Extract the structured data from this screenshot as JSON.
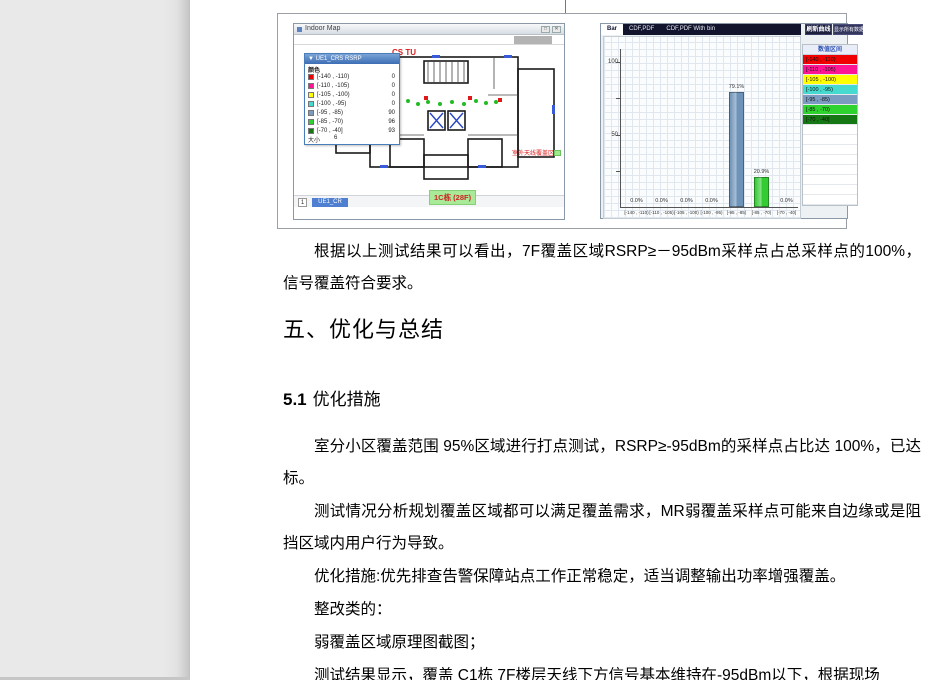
{
  "figure": {
    "indoor_map": {
      "window_title": "Indoor Map",
      "minimize_glyph": "□",
      "close_glyph": "✕",
      "legend": {
        "title": "▼ UE1_CRS RSRP",
        "color_header": "颜色",
        "rows": [
          {
            "range": "[-140 , -110)",
            "count": "0",
            "color": "#f00000"
          },
          {
            "range": "[-110 , -105)",
            "count": "0",
            "color": "#ff1493"
          },
          {
            "range": "[-105 , -100)",
            "count": "0",
            "color": "#ffff00"
          },
          {
            "range": "[-100 , -95)",
            "count": "0",
            "color": "#45d9cf"
          },
          {
            "range": "[-95 , -85)",
            "count": "90",
            "color": "#7b9cc0"
          },
          {
            "range": "[-85 , -70)",
            "count": "96",
            "color": "#2fd32f"
          },
          {
            "range": "[-70 , -40]",
            "count": "93",
            "color": "#157815"
          }
        ],
        "size_label": "大小",
        "size_value": "6"
      },
      "red_fragment": "CS TU",
      "outdoor_note": "室外天线覆盖区",
      "building_label": "1C栋 (28F)",
      "page_box": "1",
      "sheet_tab": "UE1_CR"
    },
    "chart_panel": {
      "tabs": [
        "Bar",
        "CDF,PDF",
        "CDF,PDF With bin"
      ],
      "active_tab": "Bar",
      "refresh_button": "刷新曲线",
      "show_all_button": "显示所有数据",
      "legend_header": "数值区间",
      "legend_rows": [
        {
          "range": "[-140 , -110)",
          "color": "#f00000"
        },
        {
          "range": "[-110 , -105)",
          "color": "#ff1493"
        },
        {
          "range": "[-105 , -100)",
          "color": "#ffff00"
        },
        {
          "range": "[-100 , -95)",
          "color": "#45d9cf"
        },
        {
          "range": "[-95 , -85)",
          "color": "#7b9cc0"
        },
        {
          "range": "[-85 , -70)",
          "color": "#2fd32f"
        },
        {
          "range": "[-70 , -40]",
          "color": "#157815"
        }
      ]
    }
  },
  "chart_data": {
    "type": "bar",
    "title": "",
    "categories": [
      "[-140 , -110)",
      "[-110 , -105)",
      "[-105 , -100)",
      "[-100 , -95)",
      "[-95 , -85)",
      "[-85 , -70)",
      "[-70 , -40]"
    ],
    "values": [
      0.0,
      0.0,
      0.0,
      0.0,
      79.1,
      20.9,
      0.0
    ],
    "labels": [
      "0.0%",
      "0.0%",
      "0.0%",
      "0.0%",
      "79.1%",
      "20.9%",
      "0.0%"
    ],
    "bar_colors": [
      null,
      null,
      null,
      null,
      "#6d93b8",
      "#33cc33",
      null
    ],
    "ylim": [
      0,
      100
    ],
    "yticks": [
      100,
      50
    ],
    "grid": true,
    "legend_position": "right"
  },
  "document": {
    "p_result": "根据以上测试结果可以看出，7F覆盖区域RSRP≥－95dBm采样点占总采样点的100%，信号覆盖符合要求。",
    "h1": "五、优化与总结",
    "h2_num": "5.1",
    "h2_title": "优化措施",
    "p1": "室分小区覆盖范围 95%区域进行打点测试，RSRP≥-95dBm的采样点占比达 100%，已达标。",
    "p2": "测试情况分析规划覆盖区域都可以满足覆盖需求，MR弱覆盖采样点可能来自边缘或是阻挡区域内用户行为导致。",
    "p3": "优化措施:优先排查告警保障站点工作正常稳定，适当调整输出功率增强覆盖。",
    "p4": "整改类的：",
    "p5": "弱覆盖区域原理图截图；",
    "p6": "测试结果显示，覆盖 C1栋 7F楼层天线下方信号基本维持在-95dBm以下，根据现场"
  }
}
